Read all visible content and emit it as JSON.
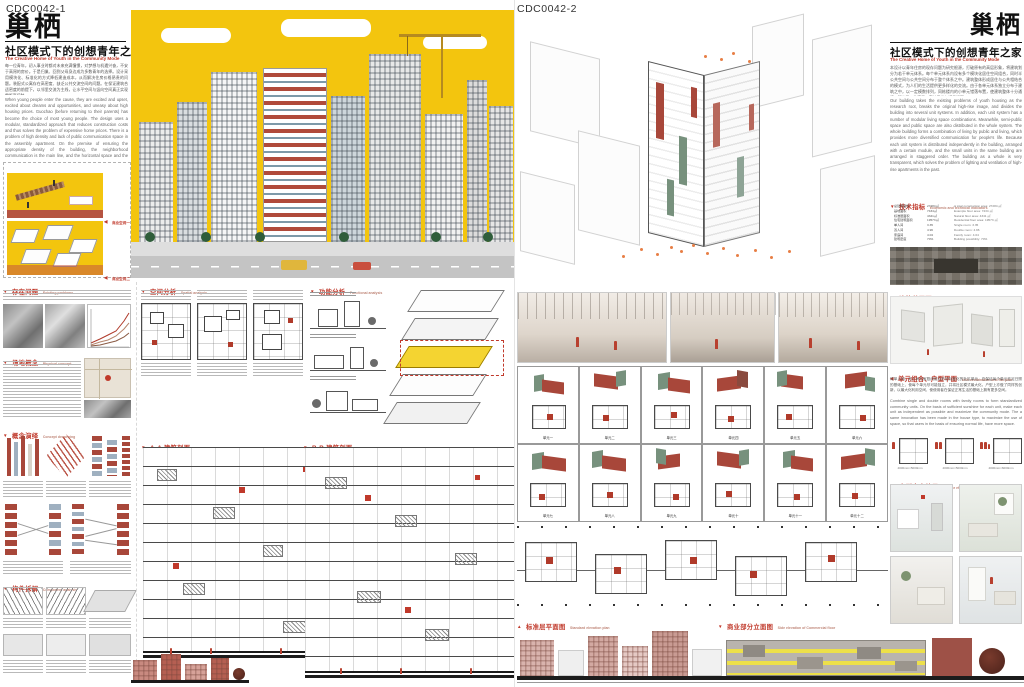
{
  "page": {
    "width": 1024,
    "height": 687,
    "bg": "#ffffff"
  },
  "colors": {
    "accent_red": "#C0392B",
    "hero_yellow": "#F3C50E",
    "brick": "#A8473A",
    "sage": "#77917D",
    "orange": "#E77E45",
    "elevation_pink": "#D9B3AD",
    "commercial_yellow": "#EDE04A"
  },
  "icons": {
    "triangle_down": "▼",
    "triangle_up": "▲",
    "triangle_left": "◀"
  },
  "board1": {
    "code": "CDC0042-1",
    "title": "巢栖",
    "subtitle_cn": "社区模式下的创想青年之家",
    "subtitle_en": "The Creative Home of Youth in the Community Mode",
    "intro_cn": "每一位青年，初入事业时都对未来充满憧憬，对梦想与机遇兴奋，不安于高昂的房价。于是归巢、回到父母身边成为多数青年的选择。设计采用模块化、标准化的方式降低建造成本，从而解决住房价格昂贵的问题。装配式公寓存在高密度、缺乏公共交流空间的问题。在保证建筑合适密度的前提下，以邻里交流为主线，让水平空间与竖向空间真正实现零距离接触。",
    "intro_en": "When young people enter the cause, they are excited and upset, excited about dreams and opportunities, and uneasy about high housing prices. Guochao (before returning to their parents) has become the choice of most young people. The design uses a modular, standardized approach that reduces construction costs and thus solves the problem of expensive home prices. There is a problem of high density and lack of public communication space in the assembly apartment. On the premise of ensuring the appropriate density of the building, the neighborhood communication is the main line, and the horizontal space and the vertical space are really in zero contact.",
    "panel_labels": [
      "商业空间一",
      "商业空间二"
    ],
    "left_sections": [
      {
        "title": "存在问题",
        "en": "Existing problems"
      },
      {
        "title": "场地概念",
        "en": "Physical concept"
      },
      {
        "title": "概念演绎",
        "en": "Concept deepening"
      },
      {
        "title": "构件拆解",
        "en": "Component analysis"
      }
    ],
    "mid_sections": [
      {
        "title": "空间分析",
        "en": "Spatial analysis"
      },
      {
        "title": "功能分析",
        "en": "Functional analysis"
      }
    ],
    "section_aa": {
      "title": "A-A 建筑剖面",
      "en": "A-A building profile"
    },
    "section_bb": {
      "title": "B-B 建筑剖面",
      "en": "B-B building profile"
    }
  },
  "board2": {
    "code": "CDC0042-2",
    "title": "巢栖",
    "subtitle_cn": "社区模式下的创想青年之家",
    "subtitle_en": "The Creative Home of Youth in the Community Mode",
    "intro_cn": "本设计以青年住房的现存问题为研究根源，打破原有的高层形象，将建筑划分为若干单元体系。每个单元体系内设有多个模块化居住空间组合，同时半公共空间与公共空间分布于整个体系之中。建筑整体形成居住与公共相结合的模式，为人们的生活提供更多样化的交流。由于各单元体系独立分布于建筑之中，以一定模数排列，同栋楼内的小单元错落布置，使建筑整体十分通透，解决了以往高层公寓的采光与通风问题。",
    "intro_en": "Our building takes the existing problems of youth housing as the research root, breaks the original high-rise image, and divides the building into several unit systems. In addition, each unit system has a number of modular living space combinations. Meanwhile, semi-public space and public space are also distributed in the whole system. The whole building forms a combination of living by public and living, which provides more diversified communication for people's life. Because each unit system is distributed independently in the building, arranged with a certain module, and the small units in the same building are arranged in staggered order. The building as a whole is very transparent, which solves the problem of lighting and ventilation of high-rise apartments in the past.",
    "indicators": {
      "title": "技术指标",
      "en": "Economic and technical indicators",
      "rows": [
        {
          "cn": "总建筑面积",
          "cv": "27284㎡",
          "en": "A total construction area:",
          "ev": "27284 ㎡"
        },
        {
          "cn": "基地面积",
          "cv": "7434㎡",
          "en": "Example floor area:",
          "ev": "7434 ㎡"
        },
        {
          "cn": "标准层面积",
          "cv": "4341㎡",
          "en": "Natural floor area:",
          "ev": "4341 ㎡"
        },
        {
          "cn": "住宅建筑面积",
          "cv": "19573㎡",
          "en": "Residential floor area:",
          "ev": "19573 ㎡"
        },
        {
          "cn": "单人间",
          "cv": "3.35",
          "en": "Single room:",
          "ev": "3.35"
        },
        {
          "cn": "双人间",
          "cv": "4.96",
          "en": "Double room:",
          "ev": "4.96"
        },
        {
          "cn": "家庭间",
          "cv": "4.04",
          "en": "Family room:",
          "ev": "4.04"
        },
        {
          "cn": "建筑密度",
          "cv": "70%",
          "en": "Building possibility:",
          "ev": "70%"
        }
      ]
    },
    "sections": {
      "general_plan": {
        "title": "建筑总平面",
        "en": "General plan"
      },
      "unit_comb": {
        "title": "单元组合、户型平面",
        "en": "Unit combination and flat plan"
      },
      "interior": {
        "title": "户型室内效果",
        "en": "Interior effect"
      },
      "std_plan": {
        "title": "标准层平面图",
        "en": "Standard elevation plan"
      },
      "commercial": {
        "title": "商业部分立面图",
        "en": "Side elevation of Commercial floor"
      }
    },
    "unit_text_cn": "将单人间、双人间与家庭间组合形成标准化的社区单元。在保证每个单元充足日照的基础上，使每个单元尽可能独立，并将社区模式最大化。户型上亦做了同样的创新，以最大化利用空间，使使用者在保证正常生活的基础上拥有更多空间。",
    "unit_text_en": "Combine single and double rooms with family rooms to form standardized community units. On the basis of sufficient sunshine for each unit, make each unit as independent as possible and maximize the community mode. The a same innovation has been made in the house type, to maximize the use of space, so that users in the basis of ensuring normal life, have more space.",
    "units": [
      "单元一",
      "单元二",
      "单元三",
      "单元四",
      "单元五",
      "单元六",
      "单元七",
      "单元八",
      "单元九",
      "单元十",
      "单元十一",
      "单元十二"
    ],
    "unit_dims": [
      "4000mm×5000mm",
      "4000mm×5000mm",
      "4000mm×6000mm"
    ]
  }
}
